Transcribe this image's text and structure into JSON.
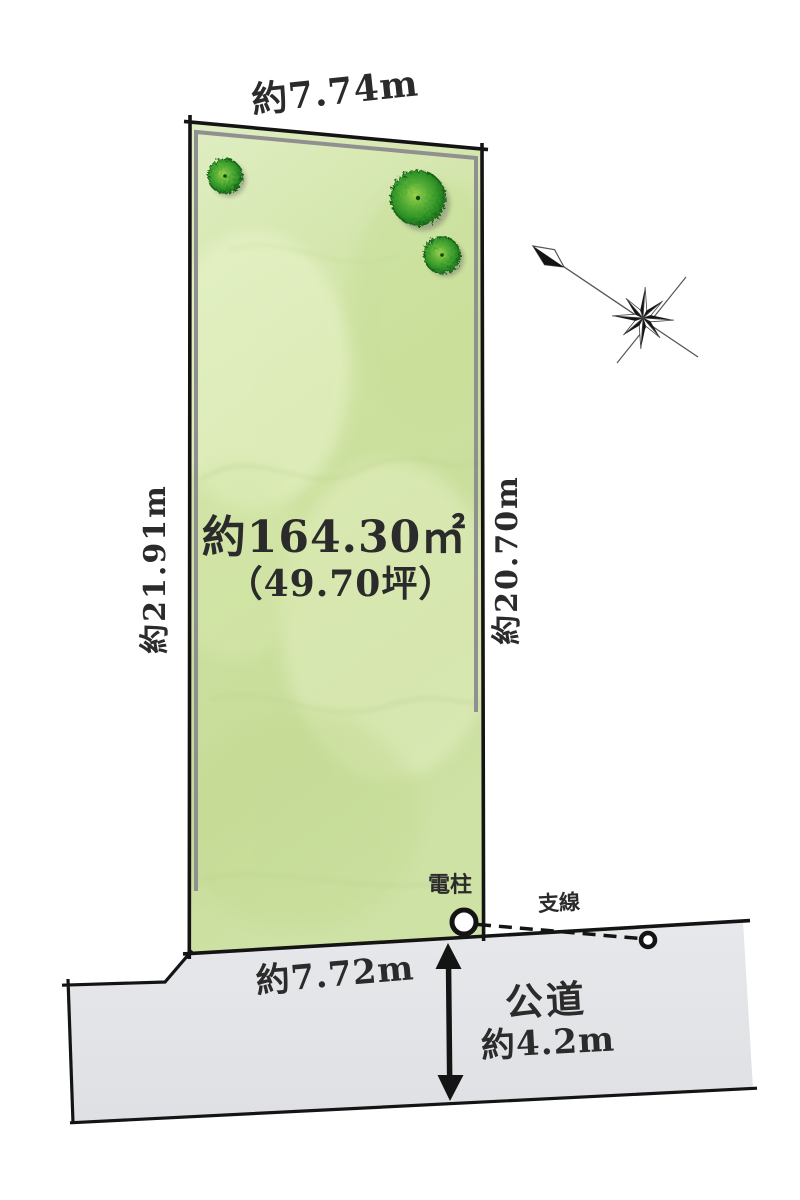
{
  "labels": {
    "top_dimension": "約7.74m",
    "left_dimension": "約21.91m",
    "right_dimension": "約20.70m",
    "area_m2": "約164.30㎡",
    "area_tsubo": "（49.70坪）",
    "frontage_dimension": "約7.72m",
    "road_name": "公道",
    "road_width": "約4.2m",
    "utility_pole": "電柱",
    "guy_wire": "支線"
  },
  "colors": {
    "plot_fill": "#cfe3a5",
    "plot_fill_light": "#dfeec2",
    "plot_border": "#141414",
    "inner_setback_line": "#909090",
    "road_fill": "#e3e4e7",
    "tree_edge": "#146414",
    "tree_center": "#9ed04e",
    "text": "#2b2b2b",
    "background": "#ffffff"
  },
  "icons": {
    "compass": "compass-rose-icon",
    "north": "north-arrow-icon",
    "trees": "tree-icon",
    "pole": "utility-pole-circle-icon",
    "wire_anchor": "guy-wire-anchor-circle-icon",
    "road_arrow": "double-headed-arrow-icon"
  }
}
